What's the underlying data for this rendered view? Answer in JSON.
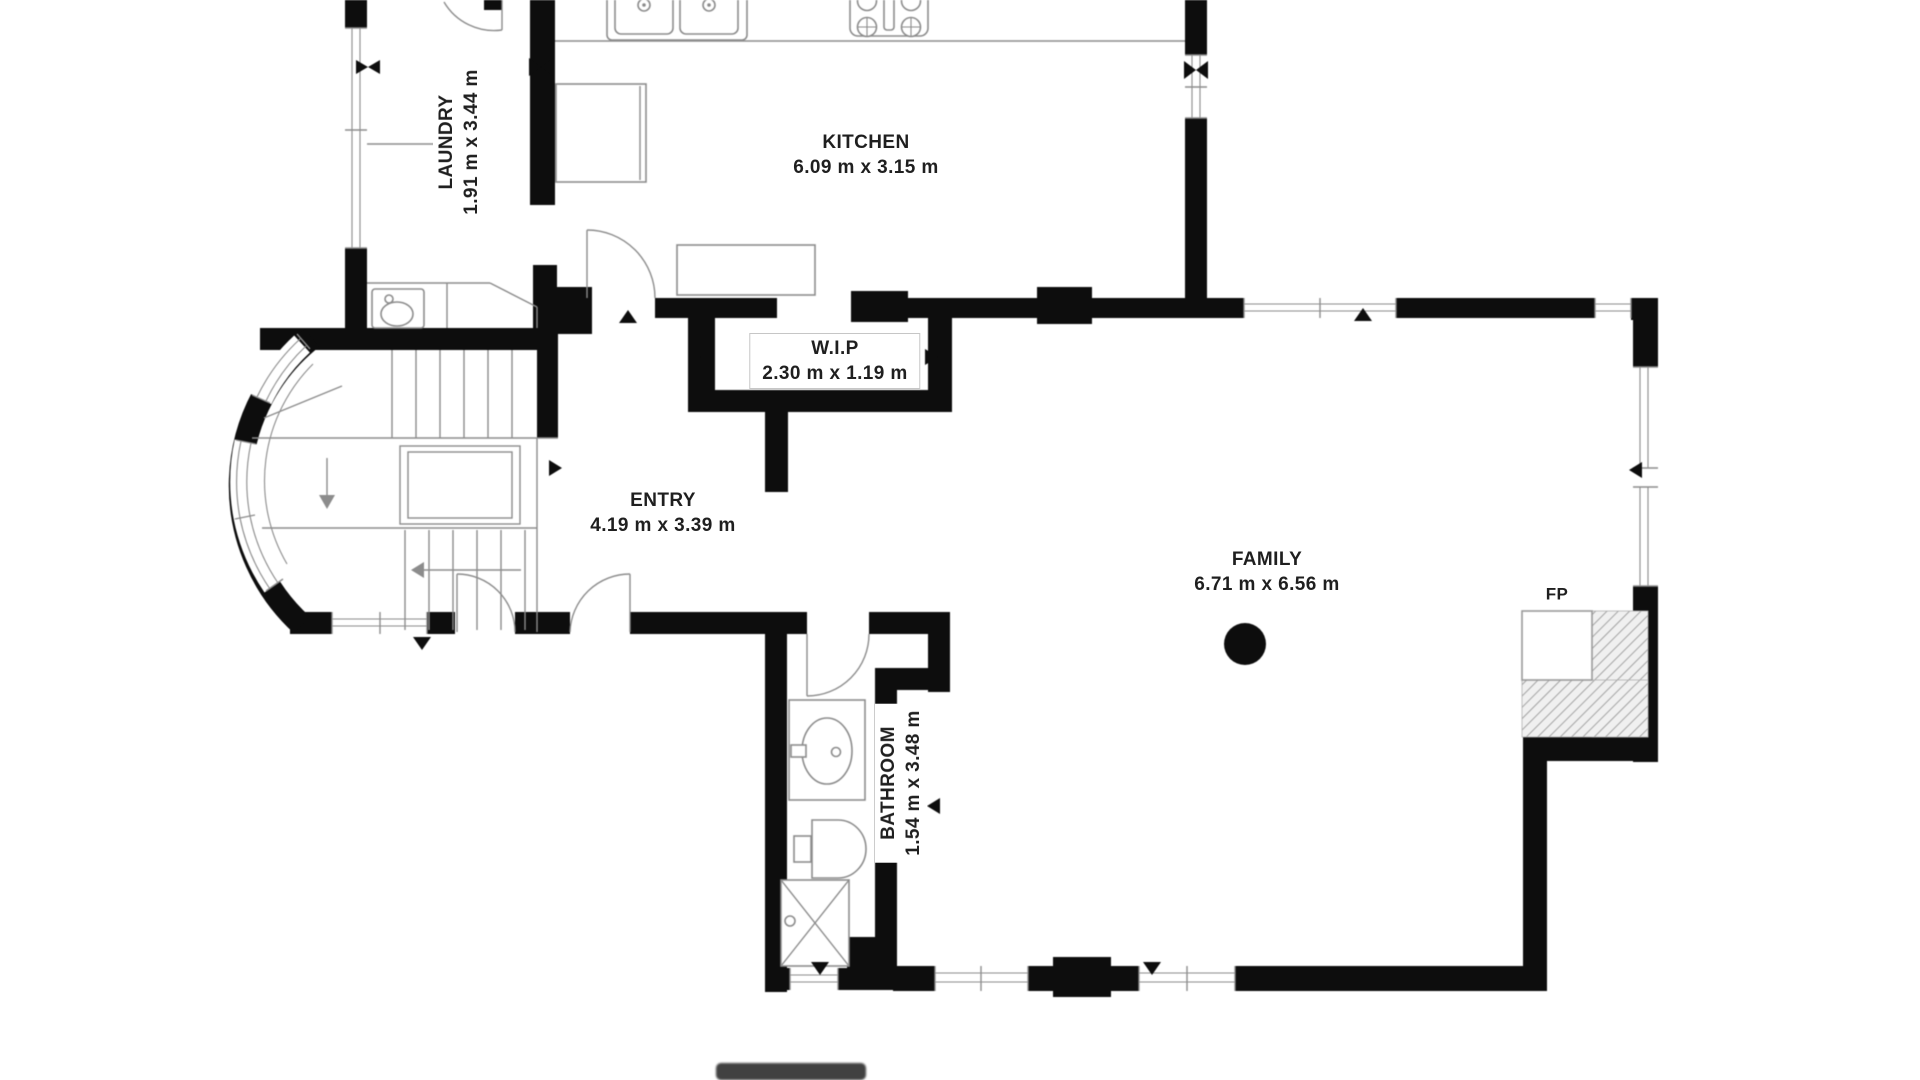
{
  "title": "First floor plan",
  "colors": {
    "bg": "#ffffff",
    "wall": "#0d0d0d",
    "line": "#8c8c8c",
    "text": "#1f1f1f",
    "hatch_bg": "#f0f0f0",
    "hatch_line": "#909090",
    "bar": "#414141"
  },
  "rooms": {
    "laundry": {
      "name": "LAUNDRY",
      "dims": "1.91 m x 3.44 m"
    },
    "kitchen": {
      "name": "KITCHEN",
      "dims": "6.09 m x 3.15 m"
    },
    "wip": {
      "name": "W.I.P",
      "dims": "2.30 m x 1.19 m"
    },
    "entry": {
      "name": "ENTRY",
      "dims": "4.19 m x 3.39 m"
    },
    "family": {
      "name": "FAMILY",
      "dims": "6.71 m x 6.56 m"
    },
    "bathroom": {
      "name": "BATHROOM",
      "dims": "1.54 m x 3.48 m"
    },
    "fireplace": {
      "name": "FP"
    }
  }
}
